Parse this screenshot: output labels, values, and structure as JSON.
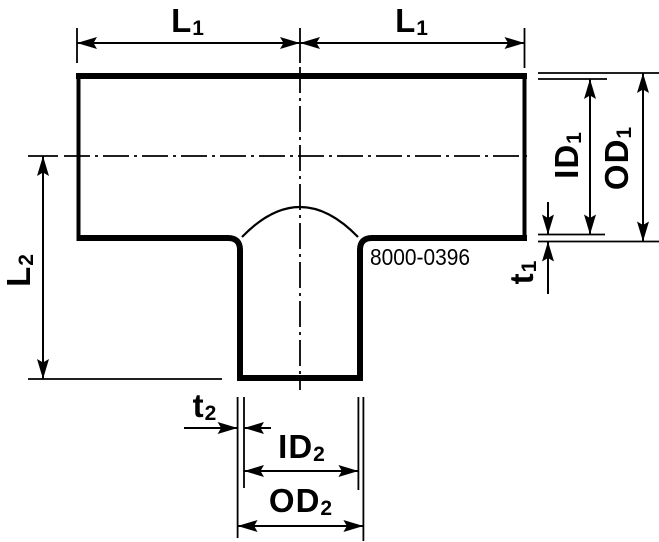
{
  "part_number": "8000-0396",
  "labels": {
    "l1": {
      "base": "L",
      "sub": "1"
    },
    "l2": {
      "base": "L",
      "sub": "2"
    },
    "id1": {
      "base": "ID",
      "sub": "1"
    },
    "od1": {
      "base": "OD",
      "sub": "1"
    },
    "t1": {
      "base": "t",
      "sub": "1"
    },
    "t2": {
      "base": "t",
      "sub": "2"
    },
    "id2": {
      "base": "ID",
      "sub": "2"
    },
    "od2": {
      "base": "OD",
      "sub": "2"
    }
  },
  "colors": {
    "line": "#000000",
    "background": "#ffffff"
  }
}
